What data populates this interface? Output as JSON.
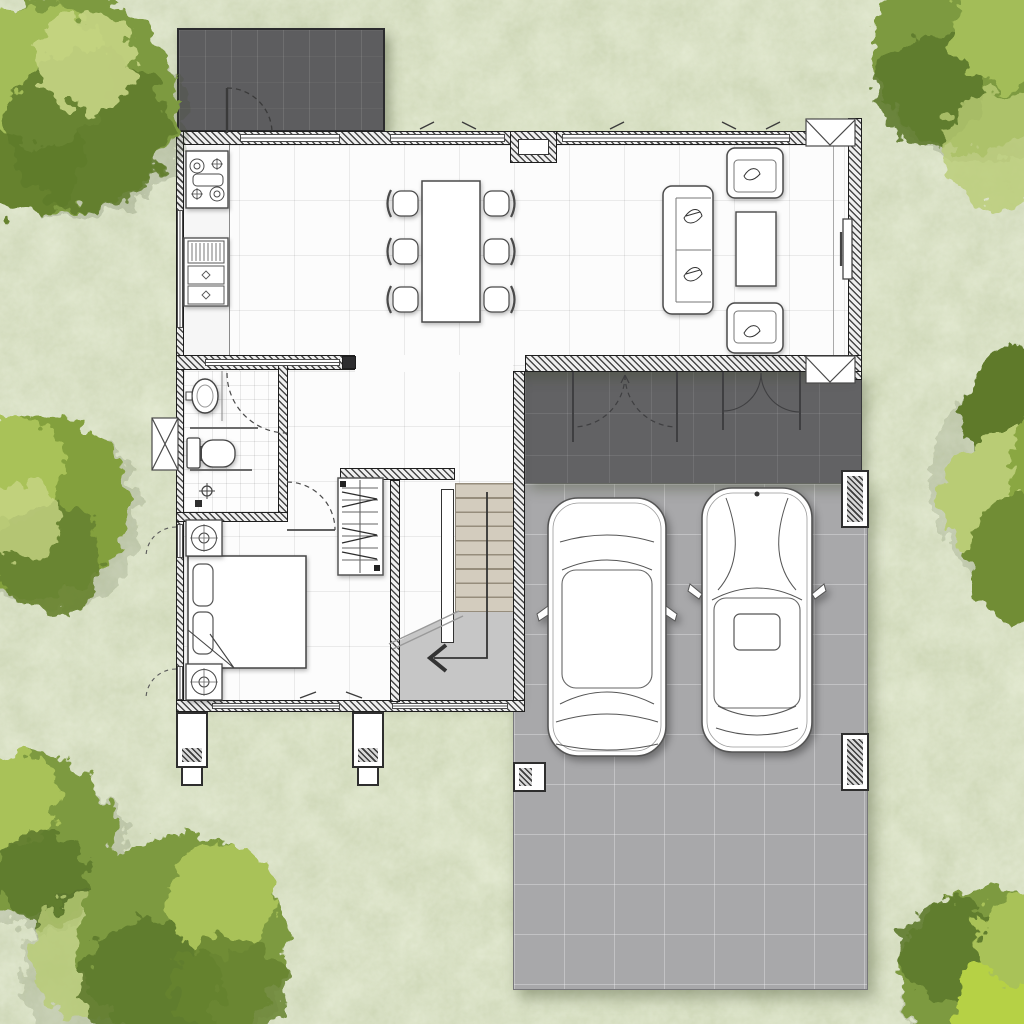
{
  "scene": {
    "type": "architectural-floor-plan",
    "view": "top-down watercolor site plan",
    "storey": "ground floor",
    "canvas_px": {
      "width": 1024,
      "height": 1024
    },
    "visible_text": "none"
  },
  "palette": {
    "lawn": "#dfe6cc",
    "patio_tile": "#5d5d5f",
    "porch_tile": "#626264",
    "driveway": "#a8a8aa",
    "interior_floor": "#fcfcfc",
    "stair_tread": "#d3ccbe",
    "stair_landing": "#c6c6c6",
    "wall_dark": "#2d2d2f",
    "line_work": "#4a4a4a",
    "tree_dark": "#5e7a2c",
    "tree_mid": "#83a03c",
    "tree_light": "#a9c258",
    "tree_pale": "#cdd98f"
  },
  "house": {
    "rooms": [
      {
        "id": "kitchen",
        "label": "Kitchen",
        "fixtures": [
          "4-burner stove",
          "sink and drainer unit with 2 cabinet doors",
          "straight counter"
        ]
      },
      {
        "id": "dining",
        "label": "Dining Area",
        "furniture": [
          "rectangular dining table"
        ],
        "chairs": 6
      },
      {
        "id": "living",
        "label": "Living Room",
        "furniture": [
          "3-seat sofa",
          "armchair",
          "armchair",
          "coffee table",
          "wall-mounted TV"
        ],
        "window_seats": 2
      },
      {
        "id": "bathroom",
        "label": "Bathroom",
        "fixtures": [
          "washbasin",
          "toilet",
          "shower",
          "towel rails"
        ]
      },
      {
        "id": "bedroom",
        "label": "Bedroom",
        "furniture": [
          "double bed with 2 pillows",
          "nightstand",
          "nightstand",
          "wardrobe closet"
        ]
      },
      {
        "id": "hall",
        "label": "Hallway and Stairs",
        "elements": [
          "staircase with landing",
          "direction arrow",
          "break line"
        ]
      },
      {
        "id": "porch",
        "label": "Covered Porch",
        "doors": [
          "double swing door (dashed)",
          "double swing door"
        ]
      },
      {
        "id": "patio",
        "label": "Back Patio",
        "doors": [
          "single swing door"
        ]
      }
    ],
    "carport": {
      "label": "Carport and Driveway",
      "cars": 2,
      "columns": 5
    },
    "openings": {
      "exterior_windows": 8,
      "exterior_doors": 3,
      "interior_doors": 2,
      "fixed_glazing_panels": 3
    }
  },
  "site": {
    "ground": "lawn",
    "tree_clusters": 7,
    "cars_parked": 2
  }
}
